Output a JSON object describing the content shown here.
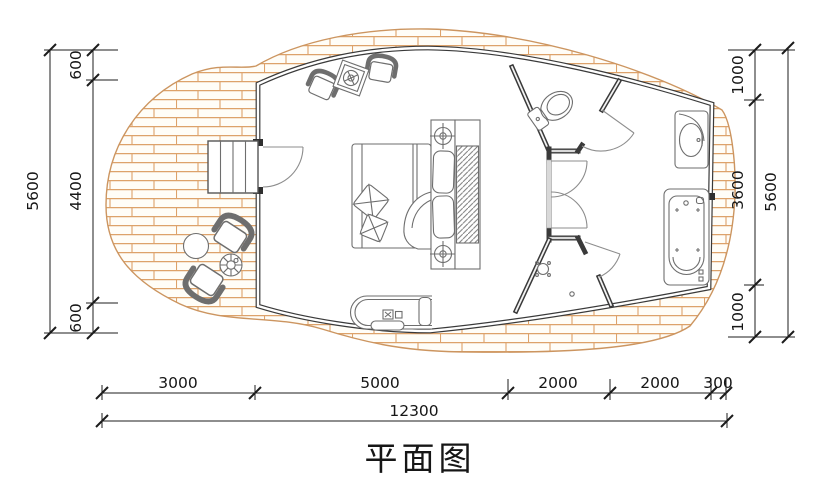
{
  "title": "平面图",
  "colors": {
    "wall": "#3a3a3a",
    "furniture_line": "#6e6e6e",
    "deck_line": "#cc9560",
    "plank_line": "#dda26a",
    "dimension_line": "#1c1c1c",
    "background": "#ffffff"
  },
  "dims": {
    "left": {
      "total": "5600",
      "segments": [
        "600",
        "4400",
        "600"
      ]
    },
    "right": {
      "total": "5600",
      "segments": [
        "1000",
        "3600",
        "1000"
      ]
    },
    "bottom": {
      "total": "12300",
      "segments": [
        "3000",
        "5000",
        "2000",
        "2000",
        "300"
      ]
    }
  },
  "fixtures": [
    "wood-deck",
    "entry-steps",
    "entry-door",
    "lounge-chair",
    "lounge-table",
    "double-bed",
    "throw-pillow",
    "bedside-lamp",
    "wardrobe",
    "bench-seat",
    "outdoor-chair",
    "outdoor-table",
    "plant-stand",
    "toilet",
    "corridor-doors",
    "shower-head",
    "floor-drain",
    "bathtub",
    "washbasin"
  ]
}
